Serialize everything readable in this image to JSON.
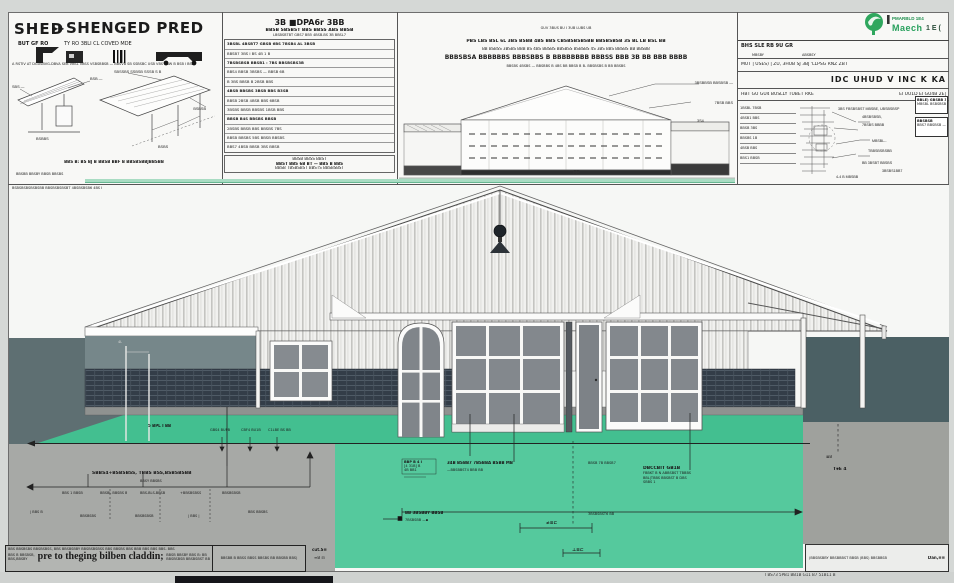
{
  "panel_shed": {
    "title_left": "SHED",
    "title_marks": "▶▶",
    "title_right": "SHENGED PRED",
    "sub_left": "BUT GF RO",
    "sub_right": "TY RO 3BLI CL COVED MDE",
    "micro_line": "A RSTIV AT DGUSBVG-DBVA SEB VBSL VBSS VSBSBBSB — BBSVB SB SSBSBC USB VBS BBW B BSB I BSS",
    "iso_labels": [
      "SBS —",
      "BSB —",
      "BSBBS",
      "SBSSBS SSBSB SSSB S B",
      "BSBSB",
      "BSBS"
    ],
    "caption": "BBS B: BS BJ B BBSB BBF B BBSBSBBJBBSBB",
    "footer": "BBSBB BBSBY BBSB BBSBS"
  },
  "panel_spec": {
    "title": "3B ■DPA6r 3BB",
    "subtitle": "BBSB SBSBST BBS BBSS ABS BBSB",
    "subtitle2": "LBSBSBTBT GBS7 BB5 4BSB-BS 3B BBSL7",
    "rows": [
      "3BSBL 4BSBT7 GBSB 6BS 7BSB4 AL 3BSB",
      "BBSB7  3BS  I BS  4B  1 B",
      "7BSBSBSB BBSB1 : 7BS BBSBSBS3B",
      "BBS4  BBSB  3BSBS — BBSB 6B",
      "B 3BS  BBSB B  2BSB  BBS",
      "4BSB BBSBS 3BSB BBS B3SB",
      "BBSB  2BSB  4BSB  BBS  6BSB",
      "3BSBS BBSB BBSBS 1BSB BBS",
      "BBSB  B4S  BBSBS  BBSB",
      "2BSBS BBSB BBS BBSBS 7BS",
      "BBSB BBSBS 5BS BBSB BBSBS",
      "BBS7 4BSB BBSB 3BS BBSB"
    ],
    "bottom": [
      "BBSB BBSS BBST",
      "BBST BBS 6B BT — BBS B BBS",
      "BBSB TBSBSBST BBSTS BBSBSBST"
    ]
  },
  "panel_elev": {
    "micro_top": "GUV 3BUS BU I 3UB LUBS UB",
    "line1": "PBS LBS BSL 6L 3BS BSBB 4BS BBS CBSBSBSBSBB BBSBSBSB 3S BL LB BSL BB",
    "line2": "BB BSBSS 3BSBS BBB BS 4BS BBSBS BBSBSS BSBSBS 4S 3BS BBS BBSBS BB BBSBB",
    "line3": "BBBSBSA BBBBBBS BBBSBBS B BBBBBBBB BBBSS BBB 3B BB BBB BBBB",
    "line4": "BBSBS 4BSBS — BBSBBS B 4BS BB BBSB B B- BBSBSBS B BB BBSBS",
    "leader1": "3BSBBSB BBSBSB —",
    "leader2": "7BSB BBS",
    "leader3": "3S4",
    "ff": "FF"
  },
  "title_block": {
    "brand_top": "PMARBLD 1E4",
    "brand_name": "Maech",
    "brand_tail": "1 E (",
    "row1": "BHS SLE RB 9U GR",
    "row1b_l": "MBSBY",
    "row1b_r": "ABSBSY",
    "row2": "MUT | USES) | ZU, 3HUB SJ  3BJ 'LLPSG RNZ  ZBT",
    "big_title": "IDC UHUD V INC K KA",
    "row3_left": "HBT GU GU4 BUSLLY TUBET RKE",
    "row3_right": "EI UU1D  EI GU4B  2E|",
    "mini_rows": [
      "1BSBL 7BSB",
      "4BSB1 BBS",
      "BBSB 3BS",
      "BBSBS 1B",
      "4BSB BBS",
      "BBS1 BBSB"
    ],
    "schem_labels": [
      "3BS FBSBSBST MBSBE, UBSBSBSP",
      "4BSBSBSB,",
      "7BSBS BBBB",
      "MBSBL--",
      "TBBSBSBSBB",
      "BB 3BSBT BBSBS",
      "3BSBS1BB7",
      "4-4 B MBSBB"
    ],
    "box1": [
      "BBLE) GBSBB 3T",
      "MBSBL  BSBSBSBB"
    ],
    "box2": [
      "BBSBSB",
      "BBS7 BBSBSB —"
    ]
  },
  "drawing": {
    "micro_note": "BSBSBSBSBSBSBB BBSBSBSBSBT 4BSBSBSB6 4BS I",
    "band_label": "5 BPL I BB",
    "band_ticks": [
      "GBS4 BUPB",
      "CBF4 BU1B",
      "C1LBE BS BB"
    ],
    "rod_label": "4L",
    "left_header": "SBBS4+BSBSBSS, TBBS BSS,BSBSBSBB",
    "left_header2": "BBSY BBSBS",
    "left_labels": [
      "BBS 1 BBSB",
      "BBSBL BBSBS B",
      "BBS-BLS-BBSB",
      "+BBSBSBSS",
      "BBSBSBSB",
      "| BBS B",
      "BBSBSBS",
      "BBSBSBSB",
      "| BBS |",
      "BBS BBSBS"
    ],
    "teal_box": [
      "BBP B 4 I",
      "[4 31B] B",
      "4B BB1"
    ],
    "teal_main1": "34B BSBB7 7BSBBA BSBB MB",
    "teal_main2": "—BBSBBST4 BBB BB",
    "teal_right": "BBSB 7B BBSB7",
    "teal_low1": "BB 3BSBBY BBSB",
    "teal_low1b": "7BSBSBB —▪",
    "teal_low2": "3BSBSBST6 BB",
    "dimA": "≠≡⊏",
    "dimB": "⊥≡⊏",
    "block_right": [
      "DBCCBIT GB1B",
      "FBBKT B N ABBSBST TBBBS",
      "BBL|TBBS BBSBST B DBS",
      "SBBS 1"
    ],
    "gray_r1": "≣B",
    "gray_r2": "T⚹E 4"
  },
  "notes": {
    "box1_top": "BBS BBSBSBS BBSBSBSS, BBS BBSBSBBY BBSBSBSBSS BBS BBSBS BBS BBB BBS BBS BBS. BBS",
    "box1_l1": "BBS B BBSBSB,",
    "box1_l2": "BBS,BBSBY",
    "box1_main": "pre to theging bilben claddin;",
    "box1_r1": "BBSB BBSBY BBS B: BB",
    "box1_r2": "BBSBSBSB BBSBSBST BB",
    "box2": "BBSBB B BBSS BBSS BBSBS BB BBSBB BBS)",
    "cut1": "cut.S≡",
    "cut2": "≡B ⊟",
    "br_text": "(BBSBSBBY BBSBBBST BBSB (BBS) BBSBBSB",
    "br_right": "Dan,≡≡",
    "bottom_micro": "I BS73 5PB1 BB1B G11 B7 51B11 B"
  }
}
